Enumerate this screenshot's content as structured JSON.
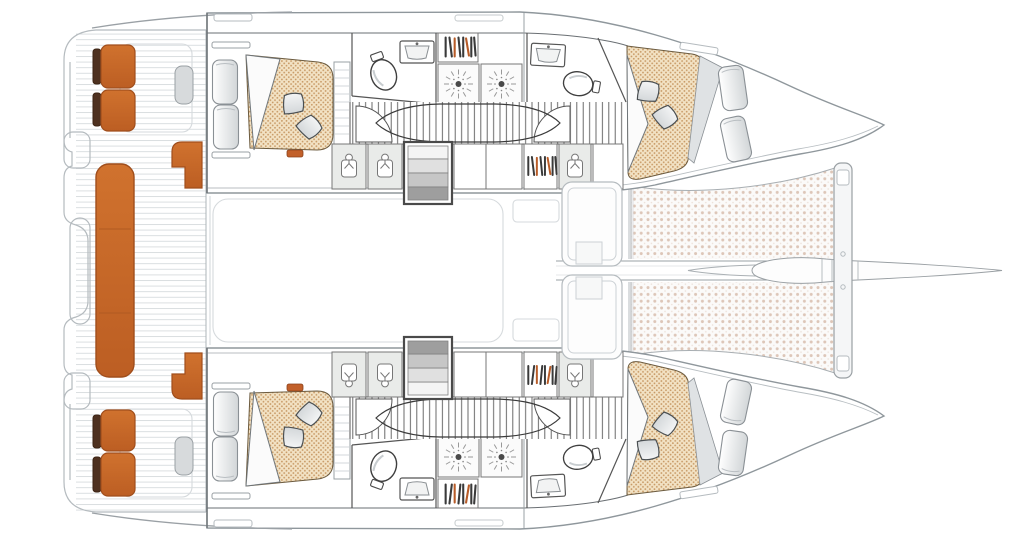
{
  "diagram": {
    "kind": "boat-floor-plan",
    "vessel": "sailing catamaran",
    "view": "top-down accommodation / deck plan",
    "orientation": {
      "bow": "right",
      "stern": "left"
    }
  },
  "colors": {
    "upholstery_orange": "#D0722E",
    "upholstery_orange_dark": "#BC5E23",
    "backrest_brown": "#4E3120",
    "accent_orange": "#C2602A",
    "mattress_tan": "#F2E2C4",
    "mattress_dot": "#C89A66",
    "trampoline_dot": "#DDC6B8",
    "book_dark": "#3A3A3A",
    "book_orange": "#B85C28",
    "step_light": "#F4F4F4",
    "step_dark": "#9E9E9E"
  },
  "cockpit": {
    "aft_bench_sections": 3,
    "side_seat_cushions": 4,
    "corner_seats": 2,
    "helm_pods": 2
  },
  "hulls": {
    "count": 2,
    "names": [
      "port",
      "starboard"
    ],
    "per_hull": {
      "cabins": 2,
      "double_berths": 2,
      "pillows": 4,
      "aft_cabin_seat_cushions": 2,
      "bow_bench_cushions": 2,
      "toilets": 2,
      "sinks": 2,
      "shower_rooms": 2,
      "bookshelf_cells": 2,
      "wardrobe_cells": 3,
      "companionway_steps": 1
    },
    "layout_sequence": [
      "aft cabin",
      "aft bathroom",
      "shower rooms",
      "corridor",
      "wardrobes and steps",
      "forward bathroom",
      "forward cabin"
    ]
  },
  "foredeck": {
    "trampoline_panels": 2,
    "lounge_benches": 2,
    "forward_crossbeam": 1,
    "bowsprit": 1
  }
}
